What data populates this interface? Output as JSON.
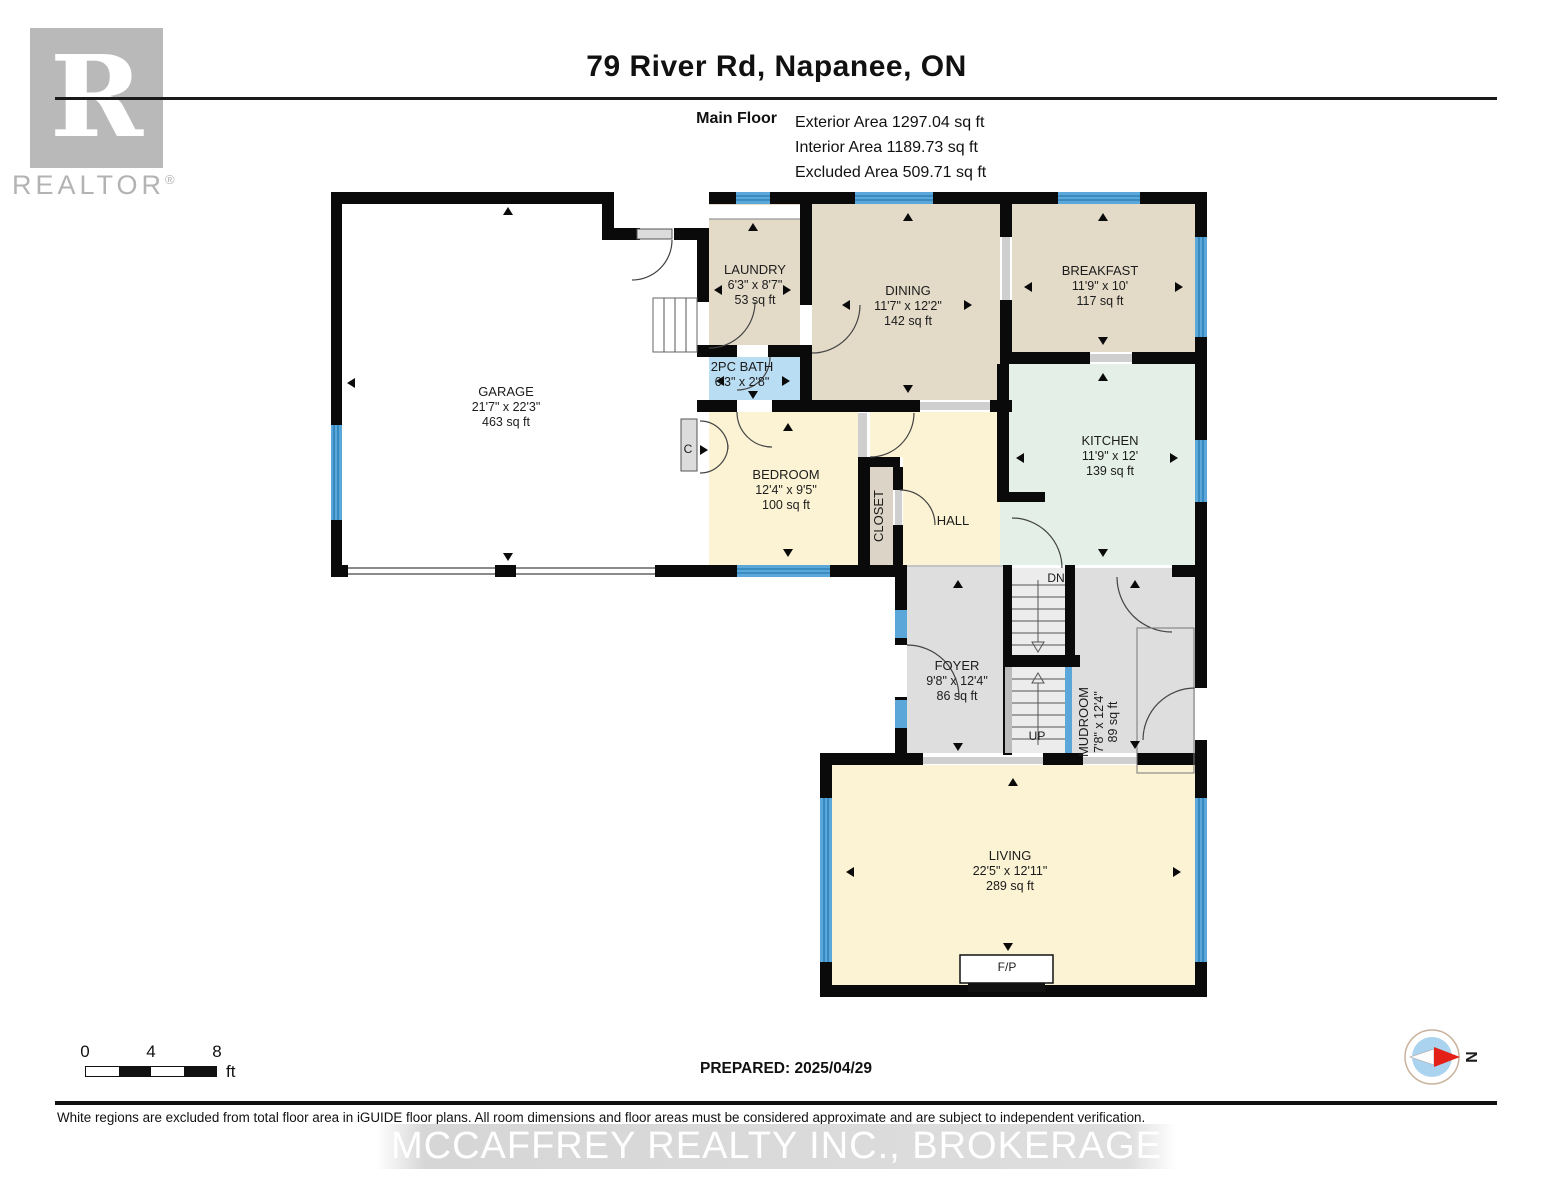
{
  "header": {
    "title": "79 River Rd, Napanee, ON",
    "floor_label": "Main Floor",
    "areas": {
      "exterior": "Exterior Area 1297.04 sq ft",
      "interior": "Interior Area 1189.73 sq ft",
      "excluded": "Excluded Area 509.71 sq ft"
    }
  },
  "logo": {
    "letter": "R",
    "word": "REALTOR",
    "reg": "®"
  },
  "rooms": [
    {
      "id": "garage",
      "name": "GARAGE",
      "dims": "21'7\" x 22'3\"",
      "area": "463 sq ft"
    },
    {
      "id": "laundry",
      "name": "LAUNDRY",
      "dims": "6'3\" x 8'7\"",
      "area": "53 sq ft"
    },
    {
      "id": "dining",
      "name": "DINING",
      "dims": "11'7\" x 12'2\"",
      "area": "142 sq ft"
    },
    {
      "id": "breakfast",
      "name": "BREAKFAST",
      "dims": "11'9\" x 10'",
      "area": "117 sq ft"
    },
    {
      "id": "bath",
      "name": "2PC BATH",
      "dims": "6'3\" x 2'8\"",
      "area": ""
    },
    {
      "id": "kitchen",
      "name": "KITCHEN",
      "dims": "11'9\" x 12'",
      "area": "139 sq ft"
    },
    {
      "id": "bedroom",
      "name": "BEDROOM",
      "dims": "12'4\" x 9'5\"",
      "area": "100 sq ft"
    },
    {
      "id": "closet",
      "name": "CLOSET",
      "dims": "",
      "area": ""
    },
    {
      "id": "hall",
      "name": "HALL",
      "dims": "",
      "area": ""
    },
    {
      "id": "foyer",
      "name": "FOYER",
      "dims": "9'8\" x 12'4\"",
      "area": "86 sq ft"
    },
    {
      "id": "mudroom",
      "name": "MUDROOM",
      "dims": "7'8\" x 12'4\"",
      "area": "89 sq ft"
    },
    {
      "id": "living",
      "name": "LIVING",
      "dims": "22'5\" x 12'11\"",
      "area": "289 sq ft"
    }
  ],
  "plan_labels": {
    "up": "UP",
    "dn": "DN",
    "closet_c": "C",
    "fireplace": "F/P"
  },
  "scale_bar": {
    "tick0": "0",
    "tick4": "4",
    "tick8": "8",
    "unit": "ft"
  },
  "footer": {
    "prepared": "PREPARED: 2025/04/29",
    "disclaimer": "White regions are excluded from total floor area in iGUIDE floor plans. All room dimensions and floor areas must be considered approximate and are subject to independent verification.",
    "watermark": "MCCAFFREY REALTY INC., BROKERAGE",
    "compass_label": "N"
  },
  "colors": {
    "wall": "#0a0a0a",
    "window_blue": "#5ba7d9",
    "room_tan": "#e3dac8",
    "room_bath_blue": "#b9ddf2",
    "room_kitchen_mint": "#e4efe8",
    "room_cream": "#fbf3d4",
    "room_gray": "#dedede",
    "excluded_white": "#ffffff",
    "compass_red": "#e32119",
    "logo_gray": "#b9b9b9"
  }
}
